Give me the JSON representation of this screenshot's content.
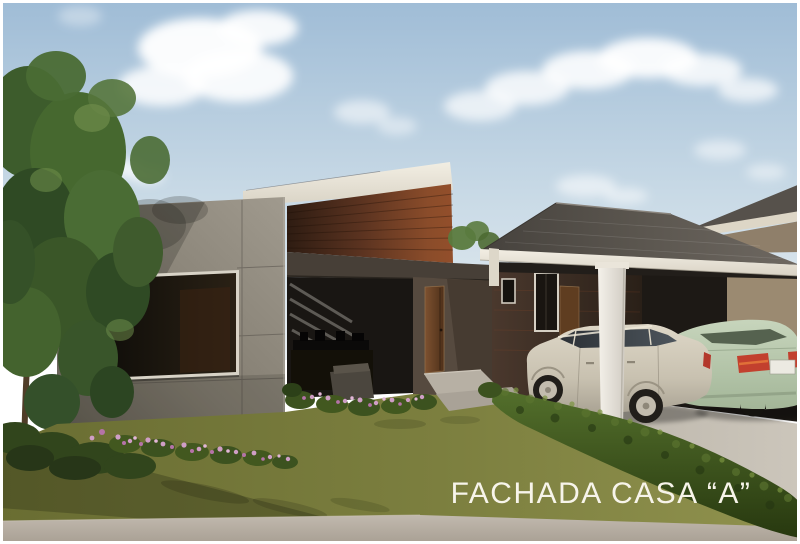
{
  "caption": {
    "text": "FACHADA CASA “A”"
  },
  "scene": {
    "type": "architectural-3d-rendering",
    "subject": "Modern single-story house facade, elevation A",
    "elements": [
      "sky",
      "clouds",
      "tree",
      "concrete-panel-wall",
      "picture-window",
      "slanted-roof-fascia",
      "brick-clerestory",
      "covered-patio",
      "patio-furniture",
      "front-door",
      "entry-steps",
      "service-wing-wall",
      "wing-windows",
      "wing-door",
      "carport-hip-roof",
      "carport-column",
      "silver-station-wagon",
      "green-sedan",
      "neighbor-roof",
      "driveway",
      "hedge",
      "lawn",
      "flower-beds",
      "sidewalk"
    ]
  },
  "palette": {
    "sky_top": "#9fbcd6",
    "sky_horizon": "#e8eef2",
    "cloud": "#ffffff",
    "concrete_wall": "#8d877b",
    "brick": "#8a4c2a",
    "roof_fascia": "#e9e4d8",
    "carport_roof": "#57524c",
    "beam_dark": "#473f37",
    "door_wood": "#6b4526",
    "lawn": "#7c7f3f",
    "hedge": "#44551f",
    "driveway": "#c2bcb2",
    "sidewalk": "#b4ada2",
    "car_silver": "#cdc6b6",
    "car_green": "#b7c9ad",
    "caption_text": "#f7f4ea",
    "frame_border": "#ffffff"
  }
}
